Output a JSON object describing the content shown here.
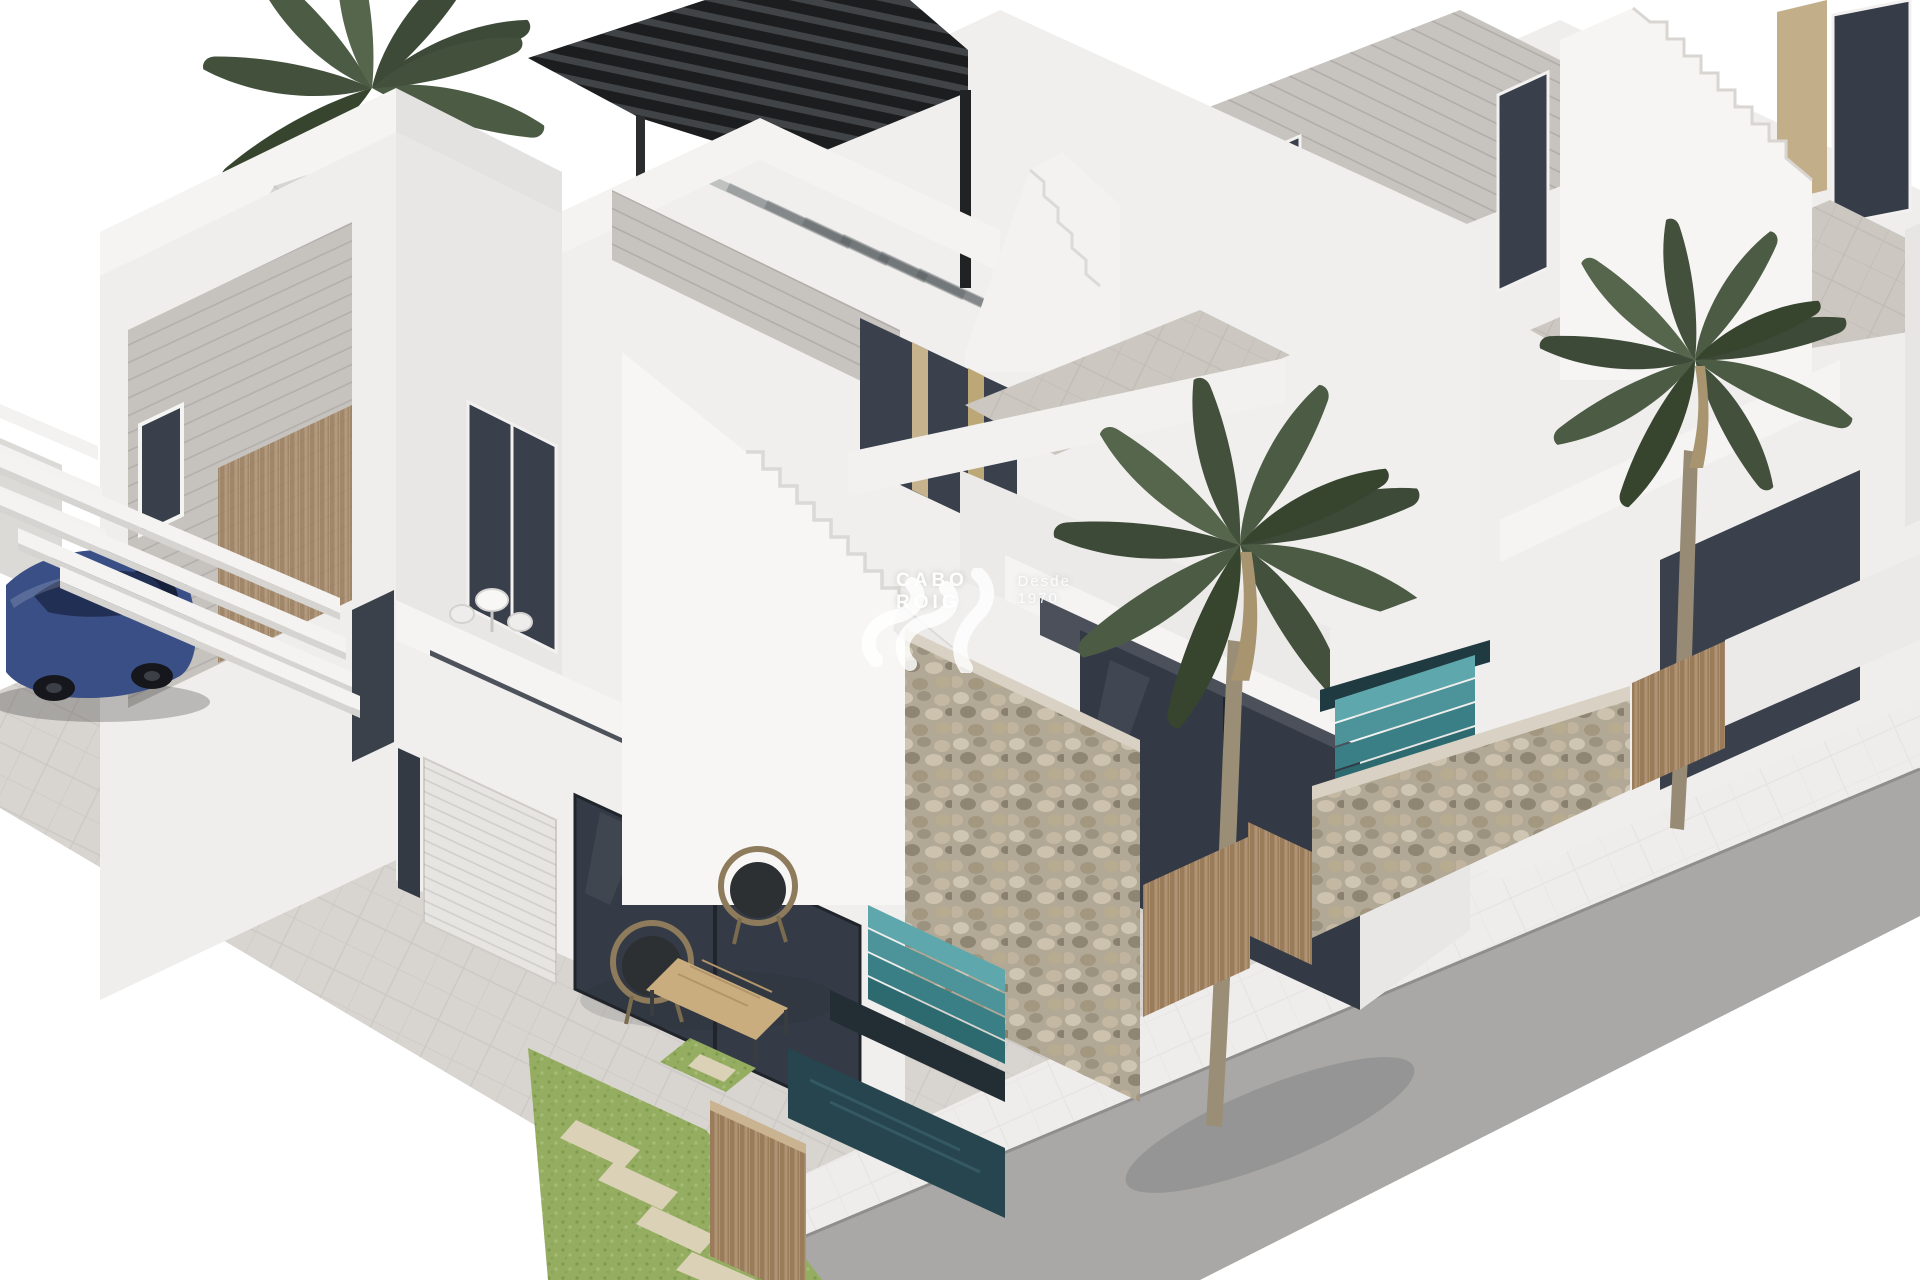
{
  "meta": {
    "type": "3d-architectural-render",
    "subject": "Row of modern white new-build villas with roof terraces, palm trees, plunge pools, stone garden walls, carport and street",
    "background": "#ffffff"
  },
  "watermark": {
    "brand": "CABO ROIG",
    "tagline": "Desde 1970",
    "logo": "wave-monogram-logo",
    "color": "#ffffff"
  },
  "palette": {
    "wall_white": "#f2f1ef",
    "wall_shaded": "#e5e3e1",
    "cladding_gray": "#c7c4c0",
    "glass_dark": "#353c47",
    "wood_beige": "#c3ae8a",
    "wood_fence": "#ab8f6c",
    "stone_wall": "#b5ab9c",
    "pool_teal": "#3f7b81",
    "pool_dark": "#27454e",
    "grass_green": "#93ac60",
    "pavement": "#d8d5d1",
    "sidewalk": "#efedeb",
    "road_gray": "#a9a8a6",
    "car_blue": "#3a4f85",
    "pergola_black": "#26282a",
    "palm_green": "#42503c",
    "parasol_gray": "#d6d5d3"
  },
  "objects": [
    {
      "name": "villa-1",
      "desc": "Front-left two-storey white villa with roof terrace, parasol, sun loungers, garage door, carport beams and terrace lounge set"
    },
    {
      "name": "blue-car",
      "desc": "Dark blue saloon parked under white carport beams"
    },
    {
      "name": "roof-parasol",
      "desc": "Grey octagonal parasol on roof terrace"
    },
    {
      "name": "sun-loungers",
      "desc": "Two dark sun loungers under the parasol"
    },
    {
      "name": "terrace-lounge-set",
      "desc": "Two round wicker chairs and wooden coffee table on ground terrace"
    },
    {
      "name": "garage-door",
      "desc": "White ribbed sectional garage door"
    },
    {
      "name": "external-staircase",
      "desc": "White external stairs leading to the roof terraces"
    },
    {
      "name": "villa-2",
      "desc": "Middle villa with black louvred pergola on roof terrace, balcony and glazed ground floor"
    },
    {
      "name": "black-pergola",
      "desc": "Black aluminium louvred pergola casting striped shadows"
    },
    {
      "name": "villa-3",
      "desc": "Right villa with external staircase and tiled terrace"
    },
    {
      "name": "villa-4",
      "desc": "Partially visible villa at the right edge"
    },
    {
      "name": "palm-trees",
      "desc": "Three tall palm trees in the front gardens"
    },
    {
      "name": "stone-walls",
      "desc": "Pebble gabion garden walls dividing the plots"
    },
    {
      "name": "wood-gates",
      "desc": "Vertical timber slat gates and fences"
    },
    {
      "name": "plunge-pools",
      "desc": "Turquoise cascading plunge pools with waterfall steps"
    },
    {
      "name": "grass-stepping-stones",
      "desc": "Green lawn strips with pale stepping stones"
    },
    {
      "name": "street",
      "desc": "Grey asphalt road with pale sidewalk along the plot"
    }
  ]
}
